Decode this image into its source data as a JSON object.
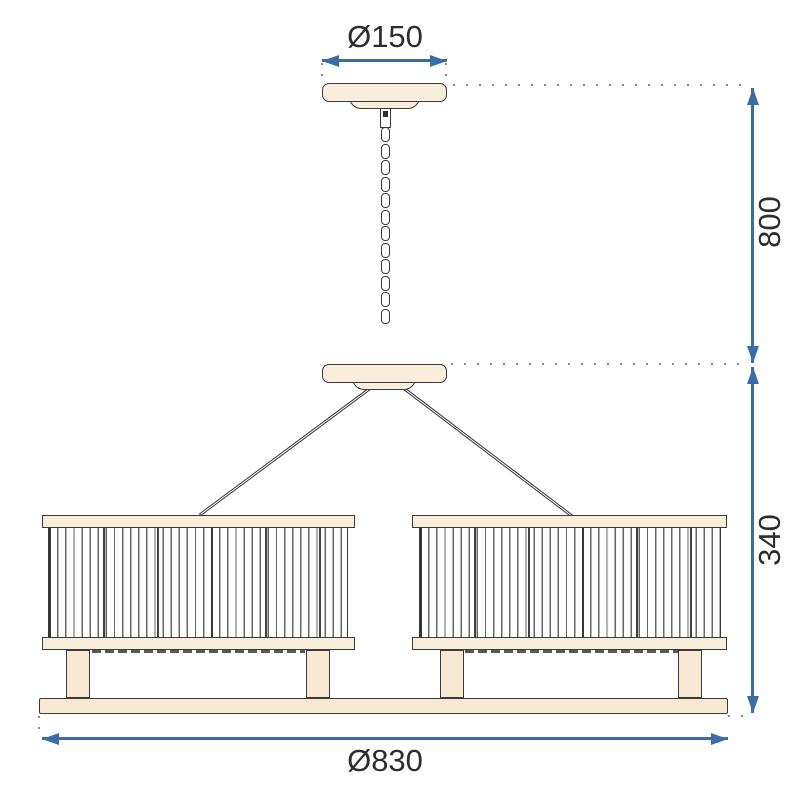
{
  "type": "technical-dimension-drawing",
  "subject": "two-shade pendant chandelier, front view",
  "dimensions": {
    "canopy_diameter": {
      "label": "Ø150",
      "value": 150,
      "position": "top"
    },
    "suspension_height": {
      "label": "800",
      "value": 800,
      "position": "right-upper"
    },
    "shade_height": {
      "label": "340",
      "value": 340,
      "position": "right-lower"
    },
    "total_diameter": {
      "label": "Ø830",
      "value": 830,
      "position": "bottom"
    }
  },
  "chain": {
    "link_count": 12
  },
  "colors": {
    "accent": "#3a6da6",
    "outline": "#3a3a3a",
    "cream": "#f9eedb",
    "cream-dark": "#f6e8d1",
    "text": "#2d2d2d",
    "dots": "#8a8a8a",
    "paper": "#ffffff"
  }
}
